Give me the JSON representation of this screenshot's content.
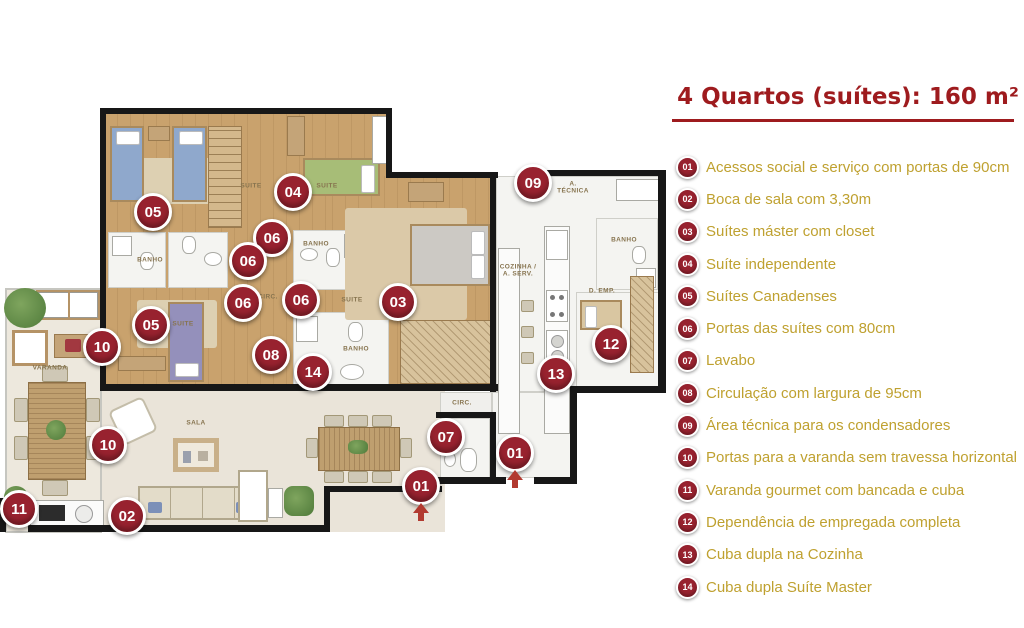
{
  "title": {
    "text": "4 Quartos (suítes): 160 m²"
  },
  "colors": {
    "title_red": "#9E1B1E",
    "marker_maroon": "#98222F",
    "legend_text_gold": "#BFA130",
    "wall_black": "#171717",
    "wood_floor": "#C9A26D",
    "living_floor": "#EAE4D9",
    "entry_arrow_red": "#B23A30"
  },
  "legend": {
    "items": [
      {
        "num": "01",
        "label": "Acessos social e serviço com portas de 90cm"
      },
      {
        "num": "02",
        "label": "Boca de sala com 3,30m"
      },
      {
        "num": "03",
        "label": "Suítes máster com closet"
      },
      {
        "num": "04",
        "label": "Suíte independente"
      },
      {
        "num": "05",
        "label": "Suítes Canadenses"
      },
      {
        "num": "06",
        "label": "Portas das suítes com 80cm"
      },
      {
        "num": "07",
        "label": "Lavabo"
      },
      {
        "num": "08",
        "label": "Circulação com largura de 95cm"
      },
      {
        "num": "09",
        "label": "Área técnica para os condensadores"
      },
      {
        "num": "10",
        "label": "Portas para a varanda sem travessa horizontal"
      },
      {
        "num": "11",
        "label": "Varanda gourmet com bancada e cuba"
      },
      {
        "num": "12",
        "label": "Dependência de empregada completa"
      },
      {
        "num": "13",
        "label": "Cuba dupla na Cozinha"
      },
      {
        "num": "14",
        "label": "Cuba dupla Suíte Master"
      }
    ]
  },
  "plan": {
    "room_labels": [
      {
        "text": "SUITE",
        "x": 251,
        "y": 186
      },
      {
        "text": "SUITE",
        "x": 327,
        "y": 186
      },
      {
        "text": "SUITE",
        "x": 352,
        "y": 300
      },
      {
        "text": "SUITE",
        "x": 183,
        "y": 324
      },
      {
        "text": "BANHO",
        "x": 150,
        "y": 260
      },
      {
        "text": "BANHO",
        "x": 316,
        "y": 244
      },
      {
        "text": "BANHO",
        "x": 356,
        "y": 349
      },
      {
        "text": "BANHO",
        "x": 624,
        "y": 240
      },
      {
        "text": "CIRC.",
        "x": 268,
        "y": 297
      },
      {
        "text": "CIRC.",
        "x": 462,
        "y": 403
      },
      {
        "text": "SALA",
        "x": 196,
        "y": 423
      },
      {
        "text": "VARANDA",
        "x": 50,
        "y": 368
      },
      {
        "text": "COZINHA /\nA. SERV.",
        "x": 518,
        "y": 271
      },
      {
        "text": "A.\nTÉCNICA",
        "x": 573,
        "y": 188
      },
      {
        "text": "D. EMP.",
        "x": 602,
        "y": 291
      },
      {
        "text": "LAV.",
        "x": 452,
        "y": 441
      }
    ],
    "markers": [
      {
        "num": "09",
        "x": 533,
        "y": 183
      },
      {
        "num": "04",
        "x": 293,
        "y": 192
      },
      {
        "num": "05",
        "x": 153,
        "y": 212
      },
      {
        "num": "06",
        "x": 272,
        "y": 238
      },
      {
        "num": "06",
        "x": 248,
        "y": 261
      },
      {
        "num": "06",
        "x": 243,
        "y": 303
      },
      {
        "num": "06",
        "x": 301,
        "y": 300
      },
      {
        "num": "03",
        "x": 398,
        "y": 302
      },
      {
        "num": "05",
        "x": 151,
        "y": 325
      },
      {
        "num": "10",
        "x": 102,
        "y": 347
      },
      {
        "num": "08",
        "x": 271,
        "y": 355
      },
      {
        "num": "14",
        "x": 313,
        "y": 372
      },
      {
        "num": "12",
        "x": 611,
        "y": 344
      },
      {
        "num": "13",
        "x": 556,
        "y": 374
      },
      {
        "num": "07",
        "x": 446,
        "y": 437
      },
      {
        "num": "10",
        "x": 108,
        "y": 445
      },
      {
        "num": "01",
        "x": 515,
        "y": 453,
        "arrow": true
      },
      {
        "num": "01",
        "x": 421,
        "y": 486,
        "arrow": true
      },
      {
        "num": "11",
        "x": 19,
        "y": 509
      },
      {
        "num": "02",
        "x": 127,
        "y": 516
      }
    ]
  }
}
